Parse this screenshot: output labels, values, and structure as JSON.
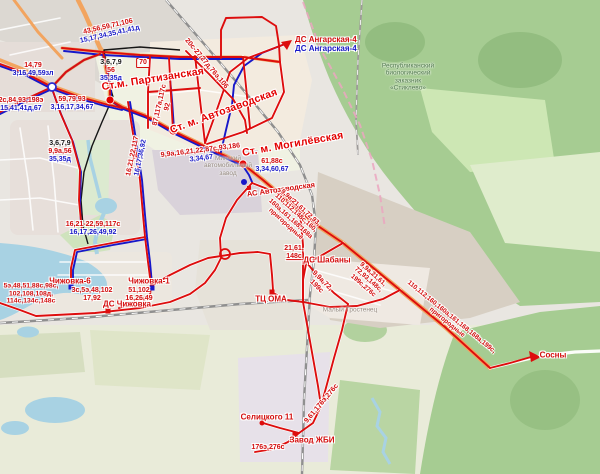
{
  "colors": {
    "bus_route_red": "#d40d0d",
    "trolleybus_route_blue": "#1717c9",
    "tram_route_black": "#151515",
    "water": "#a8d2e3",
    "forest_green": "#a6cc92"
  },
  "stations": {
    "partizanskaya": "Ст.м. Партизанская",
    "avtozavodskaya": "Ст. м. Автозаводская",
    "mogilevskaya": "Ст. м. Могилёвская"
  },
  "terminals": {
    "ds_angarskaya_bus": "ДС Ангарская-4",
    "ds_angarskaya_trolley": "ДС Ангарская-4",
    "as_avtozavodskaya": "АС Автозаводская",
    "ds_shabany": "ДС Шабаны",
    "tc_oma": "ТЦ ОМА",
    "ds_chizhovka": "ДС Чижовка",
    "chizhovka_6": "Чижовка-6",
    "chizhovka_1": "Чижовка-1",
    "sosny": "Сосны",
    "selitskogo_11": "Селицкого 11",
    "zavod_zhbi": "Завод ЖБИ"
  },
  "route_labels": {
    "nw_diagonal": {
      "red": "43,56,59,71,106",
      "blue": "15,17,34,35,41,41д"
    },
    "west_upper": {
      "red": "14,79",
      "blue": "3,16,49,59зл"
    },
    "west_lower": {
      "red": "2с,84,93,198э",
      "blue": "15,41,41д,67"
    },
    "partizanskaya_north": {
      "black": "3,6,7,9",
      "red": "56",
      "blue": "35,35д"
    },
    "route_70_box": "70",
    "junction_east": {
      "red": "59,79,93",
      "blue": "3,16,17,34,67"
    },
    "north_vertical": {
      "red1": "87,117а,117с",
      "red2": "92"
    },
    "serebryanka": {
      "black": "3,6,7,9",
      "red": "9,9а,56",
      "blue": "35,35д"
    },
    "angarskaya_diagonal": {
      "red": "20с-27,27д,76э,106"
    },
    "avenue_center": {
      "red": "9,9а,16,21,22,87с,93,186",
      "blue": "3,34,67"
    },
    "mogilevskaya_south": {
      "red": "61,88с",
      "blue": "3,34,60,67"
    },
    "ns_road": {
      "red": "16,21,22,117",
      "blue": "16,17,36,92"
    },
    "chizhovka_road": {
      "red": "16,21-22,59,117с",
      "blue": "16,17,26,49,92"
    },
    "avenue_se_bundle": {
      "red_lines": [
        "9,9а,21,61,72,93,",
        "110,112,148с,160,",
        "160а,161,168,168а",
        "пригородные"
      ]
    },
    "shabany_junction": {
      "red_lines": [
        "21,61,",
        "148с"
      ]
    },
    "shabany_diag_inner": {
      "red_lines": [
        "9,9а,72,",
        "199с"
      ]
    },
    "shabany_diag_outer": {
      "red_lines": [
        "9,9а,21,61,",
        "72,93,148с,",
        "199с,276с"
      ]
    },
    "highway_sosny": {
      "red_lines": [
        "110,112,160,160а,161,168,168а,199с,",
        "пригородные"
      ]
    },
    "chizhovka_west": {
      "red_lines": [
        "5э,48,51,88с,98с,",
        "102,108,108д,",
        "114с,134с,148с"
      ]
    },
    "chizhovka_center": {
      "red_lines": [
        "3с,5э,48,102",
        "17,92"
      ]
    },
    "chizhovka_east": {
      "red_lines": [
        "51,102",
        "16,26,49"
      ]
    },
    "south_curve": {
      "red": "9,61,176э,276с"
    },
    "zhbi_south": {
      "red": "176э,276с"
    }
  },
  "base_labels": {
    "maz_line1": "Минский",
    "maz_line2": "автомобильный",
    "maz_line3": "завод",
    "zakaznik_line1": "Республиканский",
    "zakaznik_line2": "биологический",
    "zakaznik_line3": "заказник",
    "zakaznik_line4": "«Стиклево»",
    "trostenets": "Малый Тростенец"
  }
}
